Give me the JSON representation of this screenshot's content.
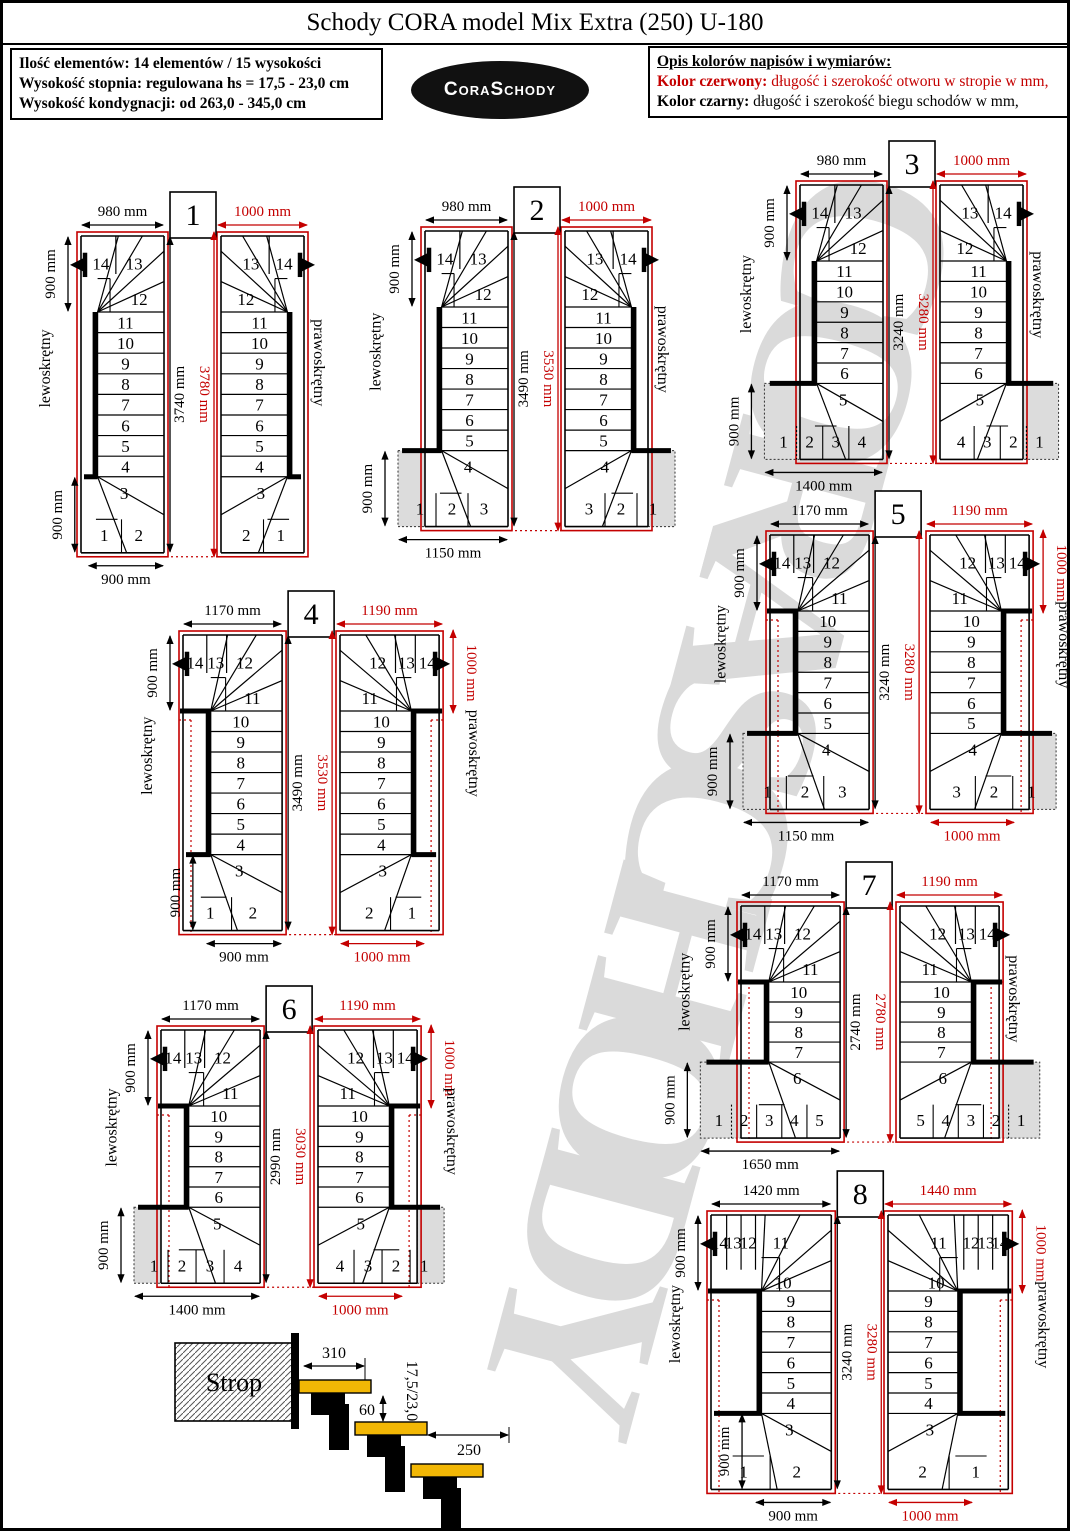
{
  "page": {
    "title": "Schody CORA model Mix Extra (250) U-180"
  },
  "info_box": {
    "lines": [
      "Ilość elementów: 14 elementów / 15 wysokości",
      "Wysokość stopnia: regulowana  hs = 17,5 - 23,0 cm",
      "Wysokość kondygnacji: od 263,0 - 345,0 cm"
    ]
  },
  "logo": {
    "text": "CoraSchody"
  },
  "legend": {
    "heading": "Opis kolorów napisów i wymiarów:",
    "red_label": "Kolor czerwony:",
    "red_text": " długość i szerokość otworu w stropie w mm,",
    "black_label": "Kolor czarny:",
    "black_text": " długość i szerokość biegu schodów w mm,"
  },
  "watermark": {
    "text": "CORASCHODY"
  },
  "labels": {
    "left_variant": "lewoskrętny",
    "right_variant": "prawoskrętny"
  },
  "colors": {
    "red": "#c40000",
    "black": "#000000",
    "gray_fill": "#dcdcdc",
    "tread_yellow": "#f2b705",
    "watermark_gray": "#d2d2d2"
  },
  "side_view": {
    "strop_label": "Strop",
    "tread_top_dim": "310",
    "offset_dim": "60",
    "step_height_range": "17,5/23,0",
    "tread_dim": "250"
  },
  "diagrams": [
    {
      "number": "1",
      "stair_width": "980 mm",
      "opening_width": "1000 mm",
      "stair_length": "3740 mm",
      "opening_length": "3780 mm",
      "top_depth": "900 mm",
      "bottom_depth": "900 mm",
      "bottom_width": "900 mm",
      "opening_side": null,
      "opening_bottom": null,
      "top_row": [
        "14",
        "13"
      ],
      "corner_step": "12",
      "flight": [
        "11",
        "10",
        "9",
        "8",
        "7",
        "6",
        "5",
        "4"
      ],
      "turn_step": "3",
      "bottom_row": [
        "1",
        "2"
      ],
      "extension": false
    },
    {
      "number": "2",
      "stair_width": "980 mm",
      "opening_width": "1000 mm",
      "stair_length": "3490 mm",
      "opening_length": "3530 mm",
      "top_depth": "900 mm",
      "bottom_depth": "900 mm",
      "bottom_width": "1150 mm",
      "opening_side": null,
      "opening_bottom": null,
      "top_row": [
        "14",
        "13"
      ],
      "corner_step": "12",
      "flight": [
        "11",
        "10",
        "9",
        "8",
        "7",
        "6",
        "5"
      ],
      "turn_step": "4",
      "bottom_row": [
        "1",
        "2",
        "3"
      ],
      "extension": true
    },
    {
      "number": "3",
      "stair_width": "980 mm",
      "opening_width": "1000 mm",
      "stair_length": "3240 mm",
      "opening_length": "3280 mm",
      "top_depth": "900 mm",
      "bottom_depth": "900 mm",
      "bottom_width": "1400 mm",
      "opening_side": null,
      "opening_bottom": null,
      "top_row": [
        "14",
        "13"
      ],
      "corner_step": "12",
      "flight": [
        "11",
        "10",
        "9",
        "8",
        "7",
        "6"
      ],
      "turn_step": "5",
      "bottom_row": [
        "1",
        "2",
        "3",
        "4"
      ],
      "extension": true
    },
    {
      "number": "4",
      "stair_width": "1170 mm",
      "opening_width": "1190 mm",
      "stair_length": "3490 mm",
      "opening_length": "3530 mm",
      "top_depth": "900 mm",
      "bottom_depth": "900 mm",
      "bottom_width": "900 mm",
      "opening_side": "1000 mm",
      "opening_bottom": "1000 mm",
      "top_row": [
        "14",
        "13",
        "12"
      ],
      "corner_step": "11",
      "flight": [
        "10",
        "9",
        "8",
        "7",
        "6",
        "5",
        "4"
      ],
      "turn_step": "3",
      "bottom_row": [
        "1",
        "2"
      ],
      "extension": false
    },
    {
      "number": "5",
      "stair_width": "1170 mm",
      "opening_width": "1190 mm",
      "stair_length": "3240 mm",
      "opening_length": "3280 mm",
      "top_depth": "900 mm",
      "bottom_depth": "900 mm",
      "bottom_width": "1150 mm",
      "opening_side": "1000 mm",
      "opening_bottom": "1000 mm",
      "top_row": [
        "14",
        "13",
        "12"
      ],
      "corner_step": "11",
      "flight": [
        "10",
        "9",
        "8",
        "7",
        "6",
        "5"
      ],
      "turn_step": "4",
      "bottom_row": [
        "1",
        "2",
        "3"
      ],
      "extension": true
    },
    {
      "number": "6",
      "stair_width": "1170 mm",
      "opening_width": "1190 mm",
      "stair_length": "2990 mm",
      "opening_length": "3030 mm",
      "top_depth": "900 mm",
      "bottom_depth": "900 mm",
      "bottom_width": "1400 mm",
      "opening_side": "1000 mm",
      "opening_bottom": "1000 mm",
      "top_row": [
        "14",
        "13",
        "12"
      ],
      "corner_step": "11",
      "flight": [
        "10",
        "9",
        "8",
        "7",
        "6"
      ],
      "turn_step": "5",
      "bottom_row": [
        "1",
        "2",
        "3",
        "4"
      ],
      "extension": true
    },
    {
      "number": "7",
      "stair_width": "1170 mm",
      "opening_width": "1190 mm",
      "stair_length": "2740 mm",
      "opening_length": "2780 mm",
      "top_depth": "900 mm",
      "bottom_depth": "900 mm",
      "bottom_width": "1650 mm",
      "opening_side": null,
      "opening_bottom": null,
      "top_row": [
        "14",
        "13",
        "12"
      ],
      "corner_step": "11",
      "flight": [
        "10",
        "9",
        "8",
        "7"
      ],
      "turn_step": "6",
      "bottom_row": [
        "1",
        "2",
        "3",
        "4",
        "5"
      ],
      "extension": true
    },
    {
      "number": "8",
      "stair_width": "1420 mm",
      "opening_width": "1440 mm",
      "stair_length": "3240 mm",
      "opening_length": "3280 mm",
      "top_depth": "900 mm",
      "bottom_depth": "900 mm",
      "bottom_width": "900 mm",
      "opening_side": "1000 mm",
      "opening_bottom": "1000 mm",
      "top_row": [
        "14",
        "13",
        "12",
        "11"
      ],
      "corner_step": "10",
      "flight": [
        "9",
        "8",
        "7",
        "6",
        "5",
        "4"
      ],
      "turn_step": "3",
      "bottom_row": [
        "1",
        "2"
      ],
      "extension": false
    }
  ]
}
